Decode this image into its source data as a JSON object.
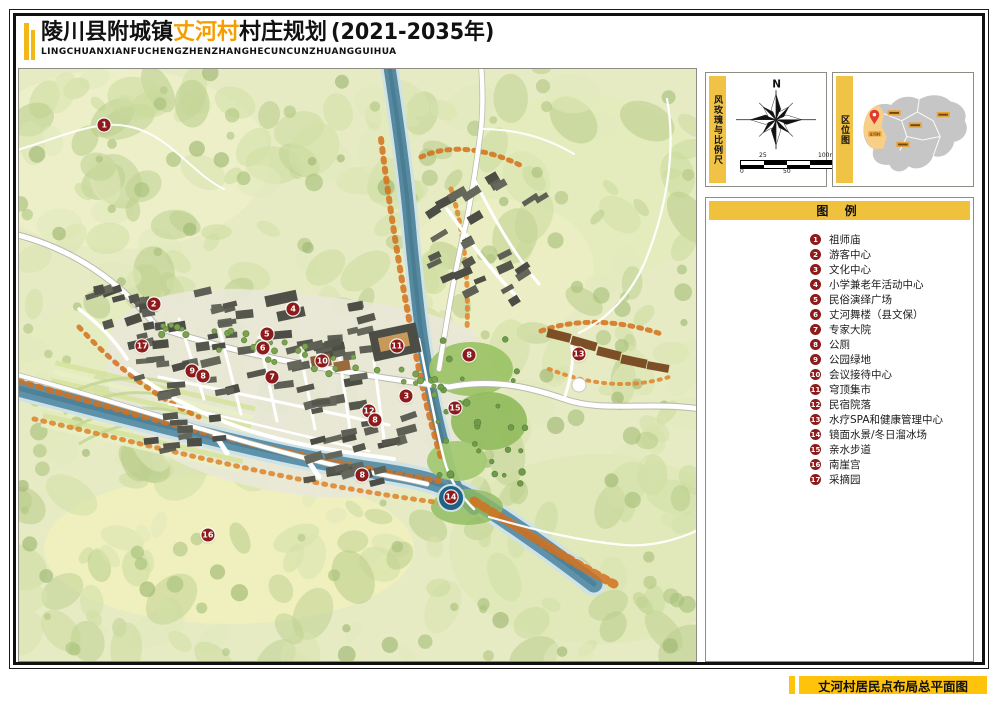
{
  "title": {
    "prefix": "陵川县附城镇",
    "highlight": "丈河村",
    "suffix": "村庄规划",
    "year": "(2021-2035年)",
    "subtitle": "LINGCHUANXIANFUCHENGZHENZHANGHECUNCUNZHUANGGUIHUA"
  },
  "sidebar": {
    "compass_panel": {
      "label": "风玫瑰与比例尺",
      "north": "N",
      "scale": {
        "top_left": "25",
        "top_right": "100m",
        "bottom_left": "0",
        "bottom_mid": "50"
      }
    },
    "location_panel": {
      "label": "区位图",
      "highlight_village": "丈河村"
    },
    "legend": {
      "header": "图 例",
      "items": [
        {
          "n": "1",
          "label": "祖师庙"
        },
        {
          "n": "2",
          "label": "游客中心"
        },
        {
          "n": "3",
          "label": "文化中心"
        },
        {
          "n": "4",
          "label": "小学兼老年活动中心"
        },
        {
          "n": "5",
          "label": "民俗演绎广场"
        },
        {
          "n": "6",
          "label": "丈河舞楼（县文保）"
        },
        {
          "n": "7",
          "label": "专家大院"
        },
        {
          "n": "8",
          "label": "公厕"
        },
        {
          "n": "9",
          "label": "公园绿地"
        },
        {
          "n": "10",
          "label": "会议接待中心"
        },
        {
          "n": "11",
          "label": "穹顶集市"
        },
        {
          "n": "12",
          "label": "民宿院落"
        },
        {
          "n": "13",
          "label": "水疗SPA和健康管理中心"
        },
        {
          "n": "14",
          "label": "镜面水景/冬日溜冰场"
        },
        {
          "n": "15",
          "label": "亲水步道"
        },
        {
          "n": "16",
          "label": "南崖宫"
        },
        {
          "n": "17",
          "label": "采摘园"
        }
      ]
    }
  },
  "footer": {
    "caption": "丈河村居民点布局总平面图"
  },
  "map": {
    "markers": [
      {
        "n": "1",
        "x": 12.6,
        "y": 9.5
      },
      {
        "n": "2",
        "x": 19.9,
        "y": 39.7
      },
      {
        "n": "4",
        "x": 40.5,
        "y": 40.5
      },
      {
        "n": "5",
        "x": 36.6,
        "y": 44.8
      },
      {
        "n": "6",
        "x": 36.0,
        "y": 47.1
      },
      {
        "n": "17",
        "x": 18.2,
        "y": 46.8
      },
      {
        "n": "9",
        "x": 25.6,
        "y": 51.0
      },
      {
        "n": "8",
        "x": 27.2,
        "y": 51.9
      },
      {
        "n": "7",
        "x": 37.4,
        "y": 52.0
      },
      {
        "n": "10",
        "x": 44.8,
        "y": 49.3
      },
      {
        "n": "11",
        "x": 55.8,
        "y": 46.8
      },
      {
        "n": "8",
        "x": 66.5,
        "y": 48.3
      },
      {
        "n": "13",
        "x": 82.7,
        "y": 48.1
      },
      {
        "n": "3",
        "x": 57.2,
        "y": 55.2
      },
      {
        "n": "12",
        "x": 51.7,
        "y": 57.8
      },
      {
        "n": "8",
        "x": 52.6,
        "y": 59.3
      },
      {
        "n": "15",
        "x": 64.4,
        "y": 57.3
      },
      {
        "n": "8",
        "x": 50.7,
        "y": 68.6
      },
      {
        "n": "14",
        "x": 63.8,
        "y": 72.3
      },
      {
        "n": "16",
        "x": 27.9,
        "y": 78.7
      }
    ]
  },
  "colors": {
    "accent_yellow": "#F0C245",
    "footer_yellow": "#FFC30B",
    "title_orange": "#F59E00",
    "marker_red": "#8E1B1B"
  }
}
